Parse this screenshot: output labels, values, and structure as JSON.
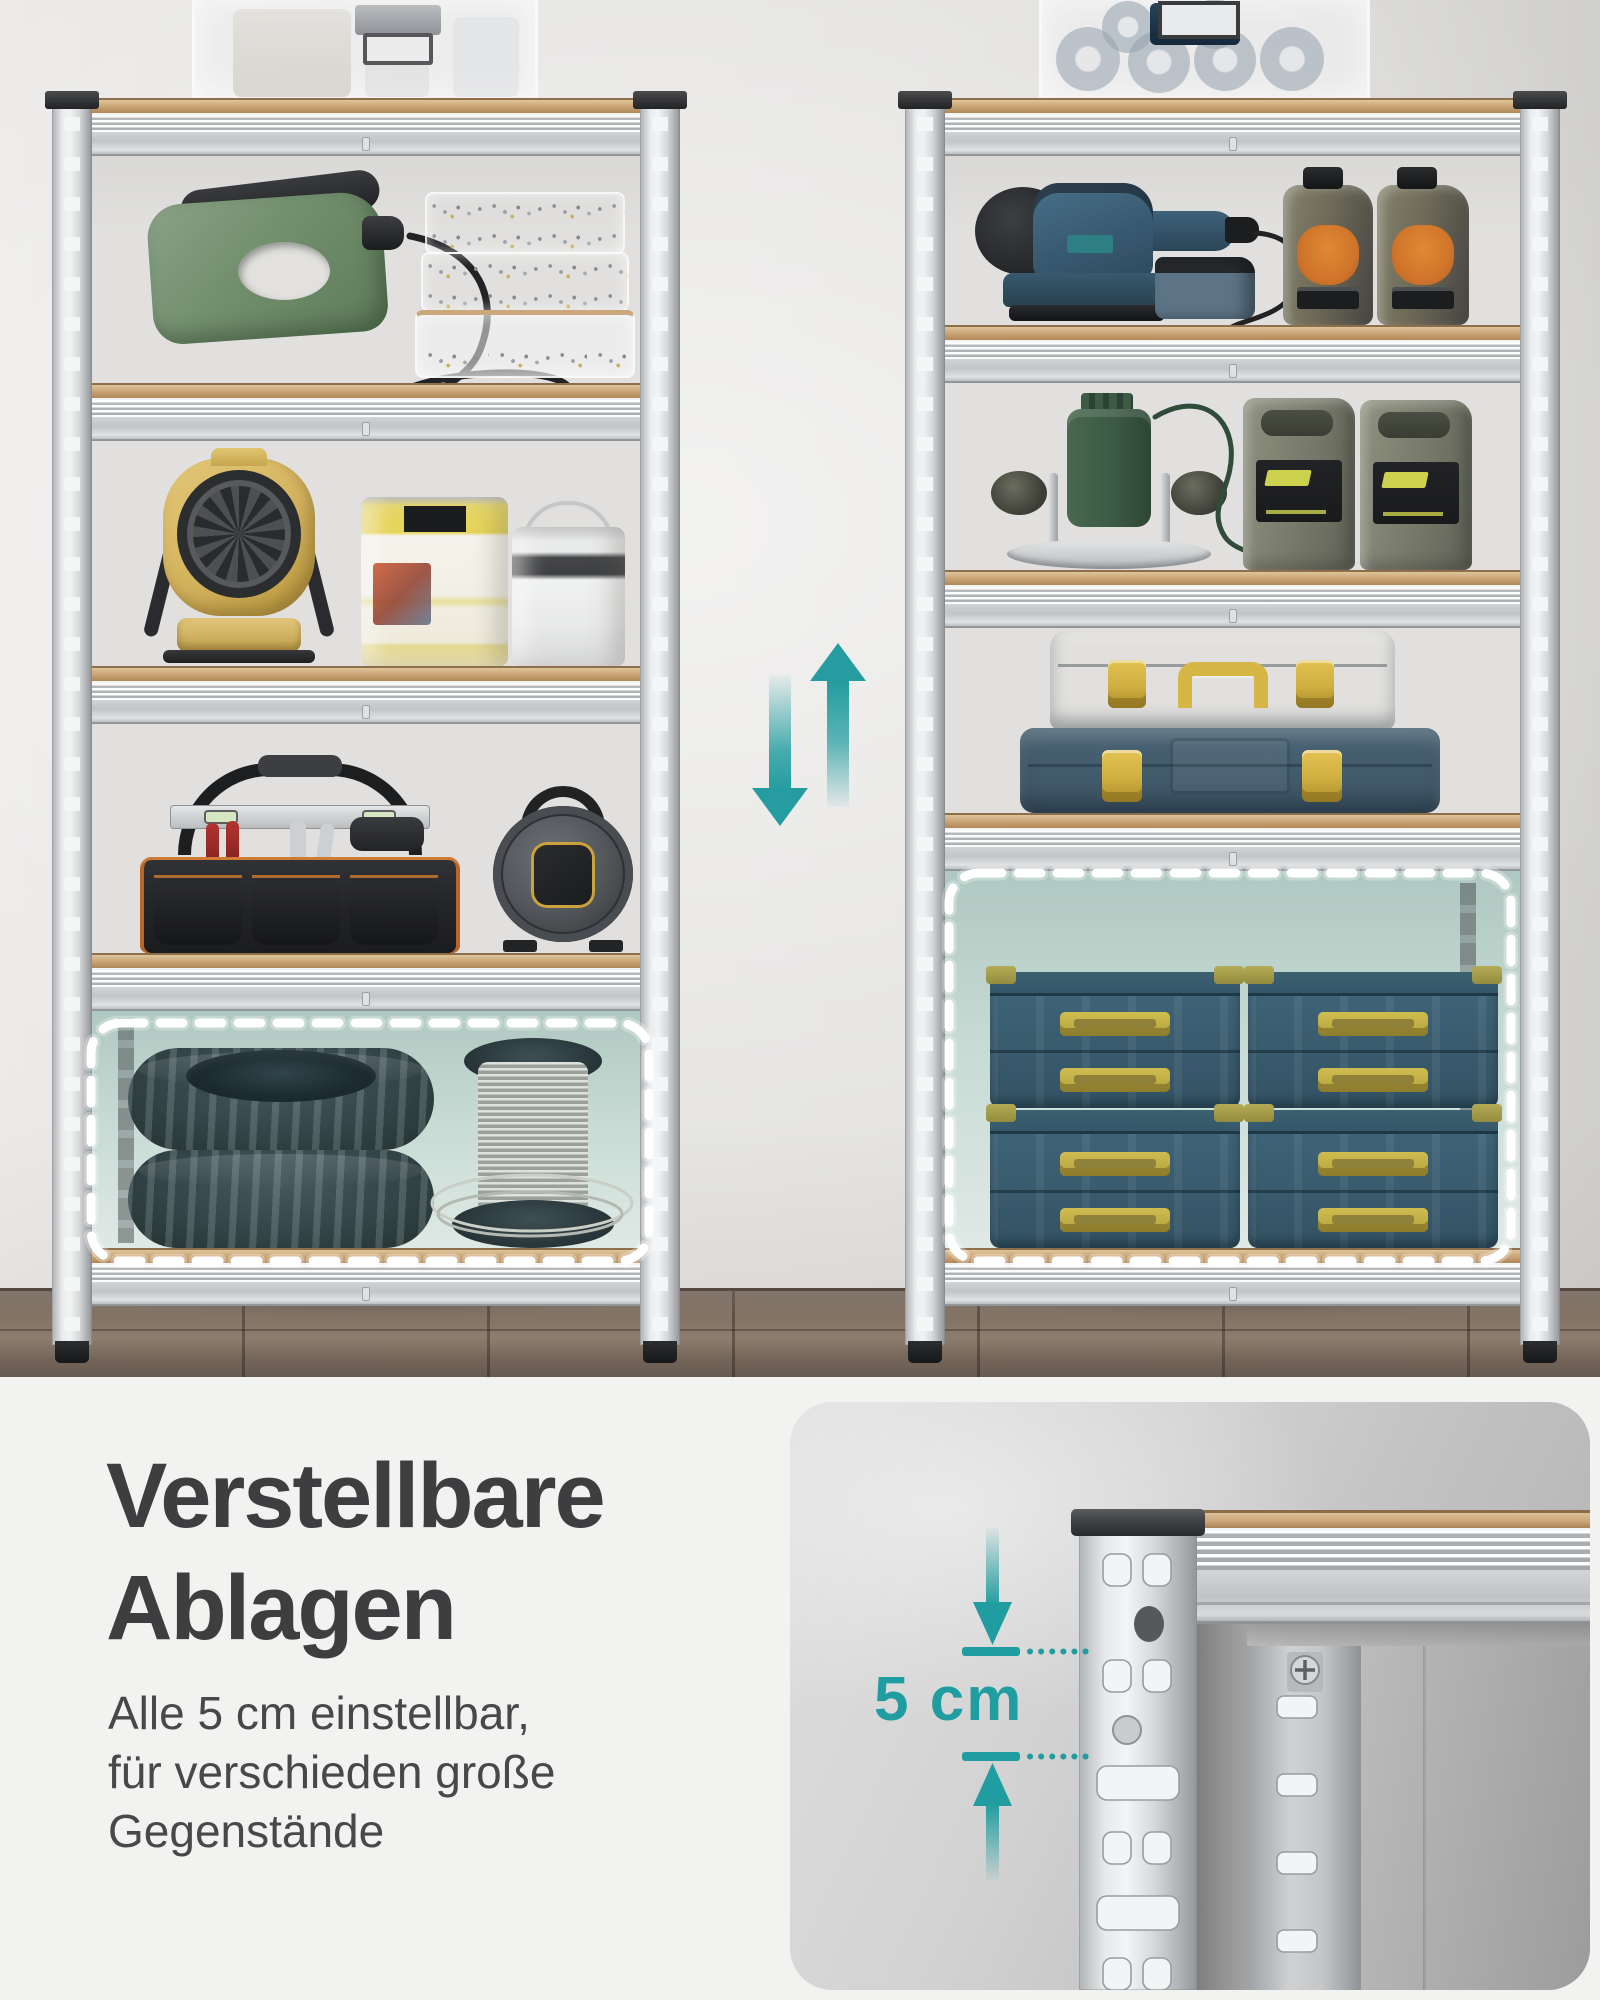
{
  "headline": {
    "line1": "Verstellbare",
    "line2": "Ablagen"
  },
  "description": {
    "line1": "Alle 5 cm einstellbar,",
    "line2": "für verschieden große",
    "line3": "Gegenstände"
  },
  "inset": {
    "measurement_label": "5 cm"
  },
  "icons": {
    "shelf_move_down": "arrow-down",
    "shelf_move_up": "arrow-up",
    "dimension_arrow_down": "arrow-down",
    "dimension_arrow_up": "arrow-up"
  },
  "colors": {
    "accent_teal": "#1f9da0",
    "headline_text": "#3e3e40",
    "body_text": "#48484a",
    "dash_highlight": "#ffffff",
    "wall": "#e3e2e0",
    "floor_wood": "#7b6b5e",
    "shelf_wood_edge": "#cda87a",
    "frame_metal": "#d8dadc",
    "compartment_tint": "#c7dad4",
    "bottom_background": "#f2f2f1",
    "inset_background": "#c9c8c8"
  }
}
